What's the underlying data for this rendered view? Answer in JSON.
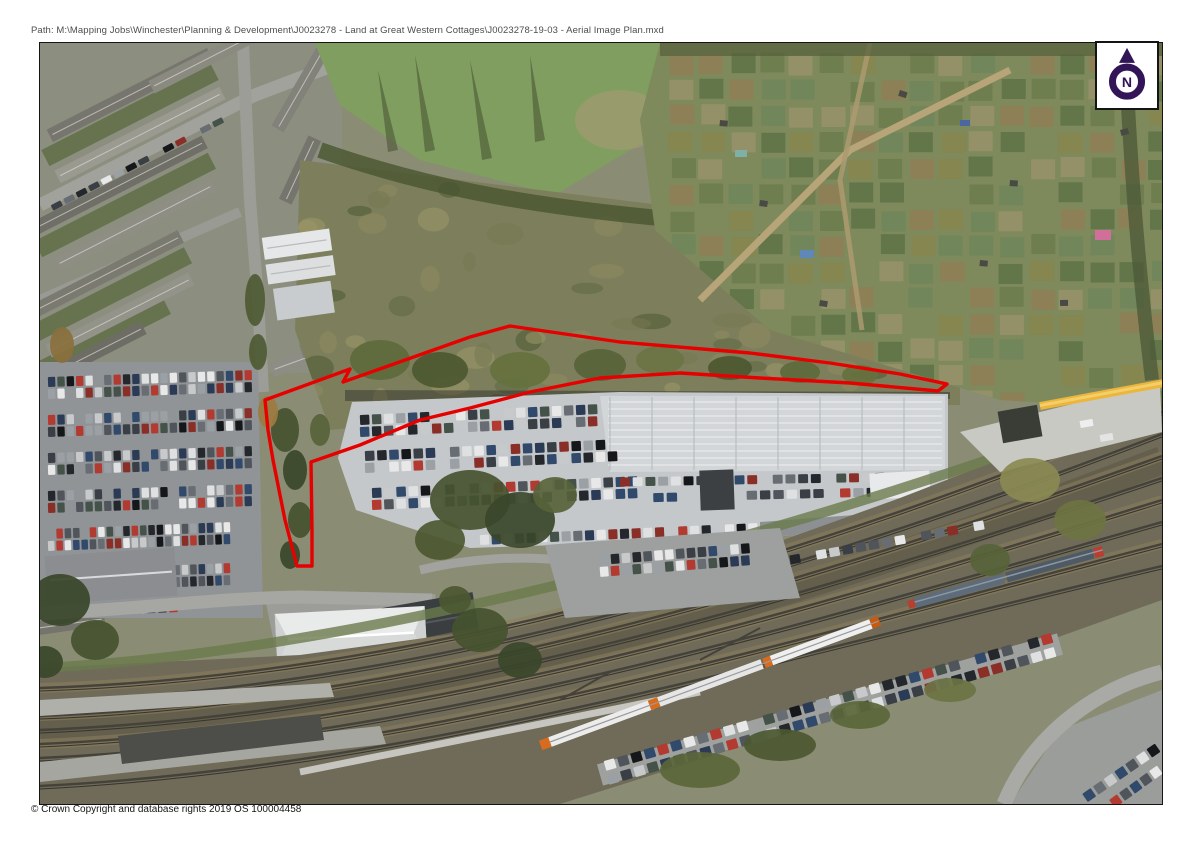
{
  "page": {
    "path_label": "Path: M:\\Mapping Jobs\\Winchester\\Planning & Development\\J0023278 - Land at Great Western Cottages\\J0023278-19-03 - Aerial Image Plan.mxd",
    "copyright_label": "© Crown Copyright and database rights 2019 OS 100004458"
  },
  "north_arrow": {
    "label": "N",
    "color": "#311557"
  },
  "site_boundary": {
    "color": "#e60000",
    "stroke_width": 3.4,
    "points": [
      [
        265,
        400
      ],
      [
        350,
        369
      ],
      [
        343,
        382
      ],
      [
        470,
        337
      ],
      [
        510,
        326
      ],
      [
        620,
        342
      ],
      [
        750,
        353
      ],
      [
        830,
        363
      ],
      [
        900,
        374
      ],
      [
        947,
        384
      ],
      [
        938,
        391
      ],
      [
        850,
        383
      ],
      [
        760,
        378
      ],
      [
        680,
        373
      ],
      [
        600,
        378
      ],
      [
        530,
        392
      ],
      [
        470,
        408
      ],
      [
        420,
        420
      ],
      [
        360,
        445
      ],
      [
        311,
        462
      ],
      [
        312,
        530
      ],
      [
        312,
        566
      ],
      [
        297,
        566
      ],
      [
        285,
        520
      ],
      [
        273,
        460
      ],
      [
        268,
        430
      ]
    ]
  }
}
